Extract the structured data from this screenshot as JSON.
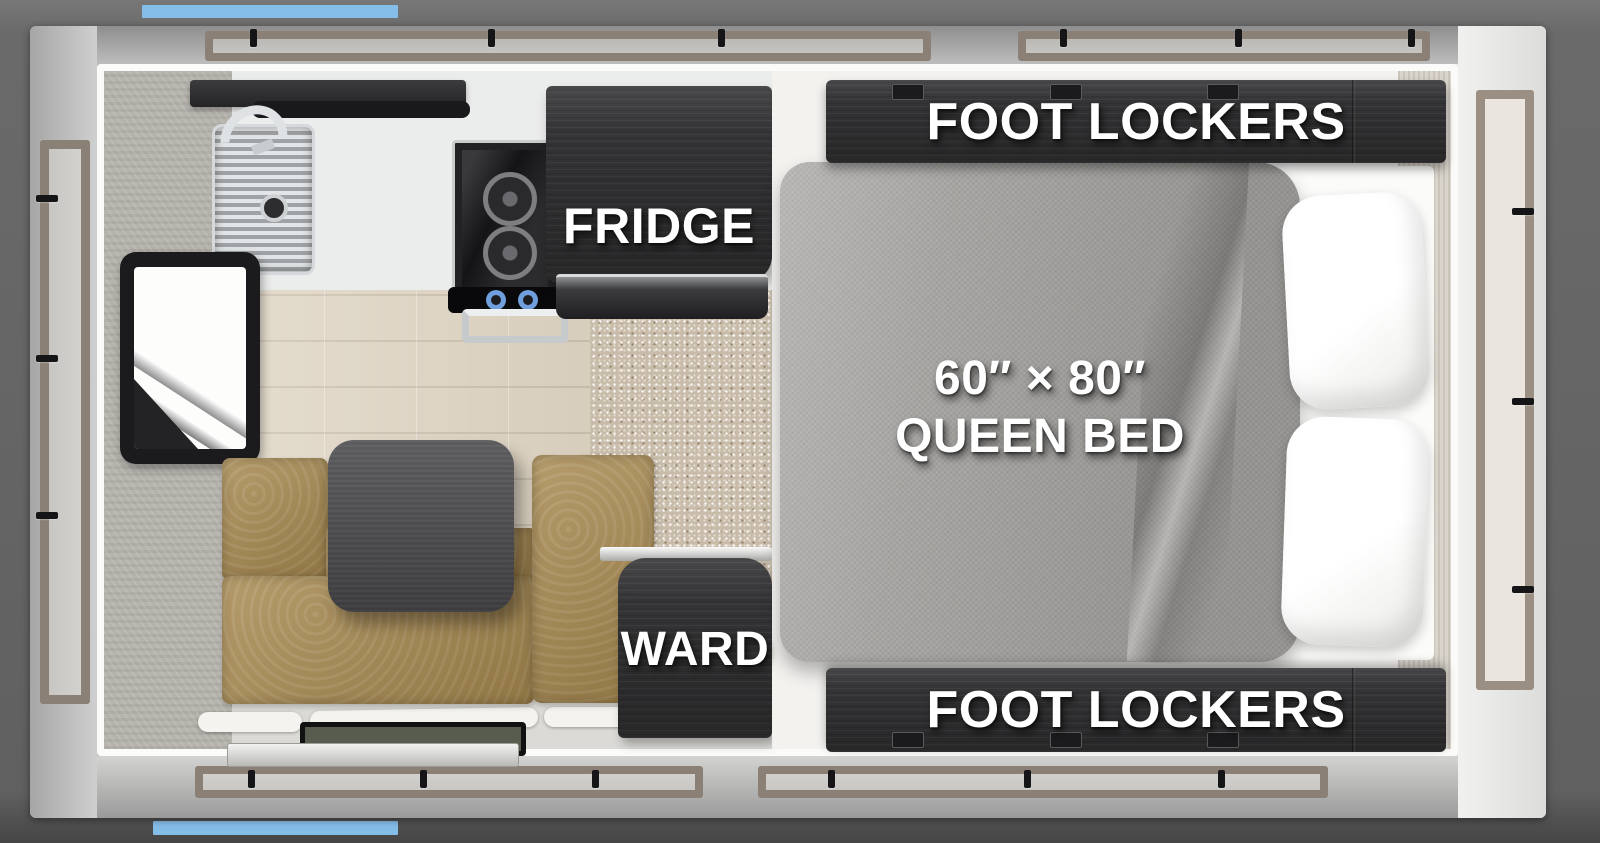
{
  "floorplan": {
    "title": "truck-camper-floor-plan",
    "labels": {
      "foot_lockers_top": "FOOT LOCKERS",
      "foot_lockers_bottom": "FOOT LOCKERS",
      "fridge": "FRIDGE",
      "ward": "WARD",
      "bed_size": "60″ × 80″",
      "bed_name": "QUEEN BED"
    },
    "colors": {
      "accent_blue": "#85BCE9",
      "background_gray": "#646464",
      "body_gray": "#C6C6C6",
      "cabinet_dark": "#343436",
      "bed_gray": "#A7A5A2",
      "dinette_tan": "#A8894F",
      "carpet_tan": "#C8BBA9",
      "wood_floor": "#DCD1BE",
      "window_frame_tan": "#8A8076",
      "label_white": "#FFFFFF"
    }
  }
}
